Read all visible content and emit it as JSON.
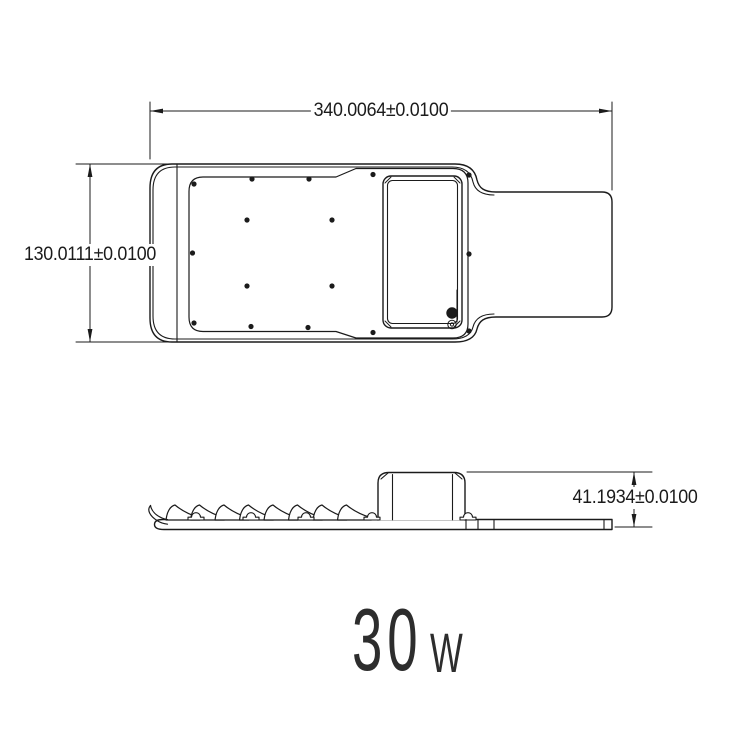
{
  "dimensions": {
    "top_width": "340.0064±0.0100",
    "left_height": "130.0111±0.0100",
    "side_height": "41.1934±0.0100"
  },
  "power": {
    "value": "30",
    "unit": "W"
  },
  "colors": {
    "line": "#1b1b1b",
    "background": "#ffffff"
  }
}
